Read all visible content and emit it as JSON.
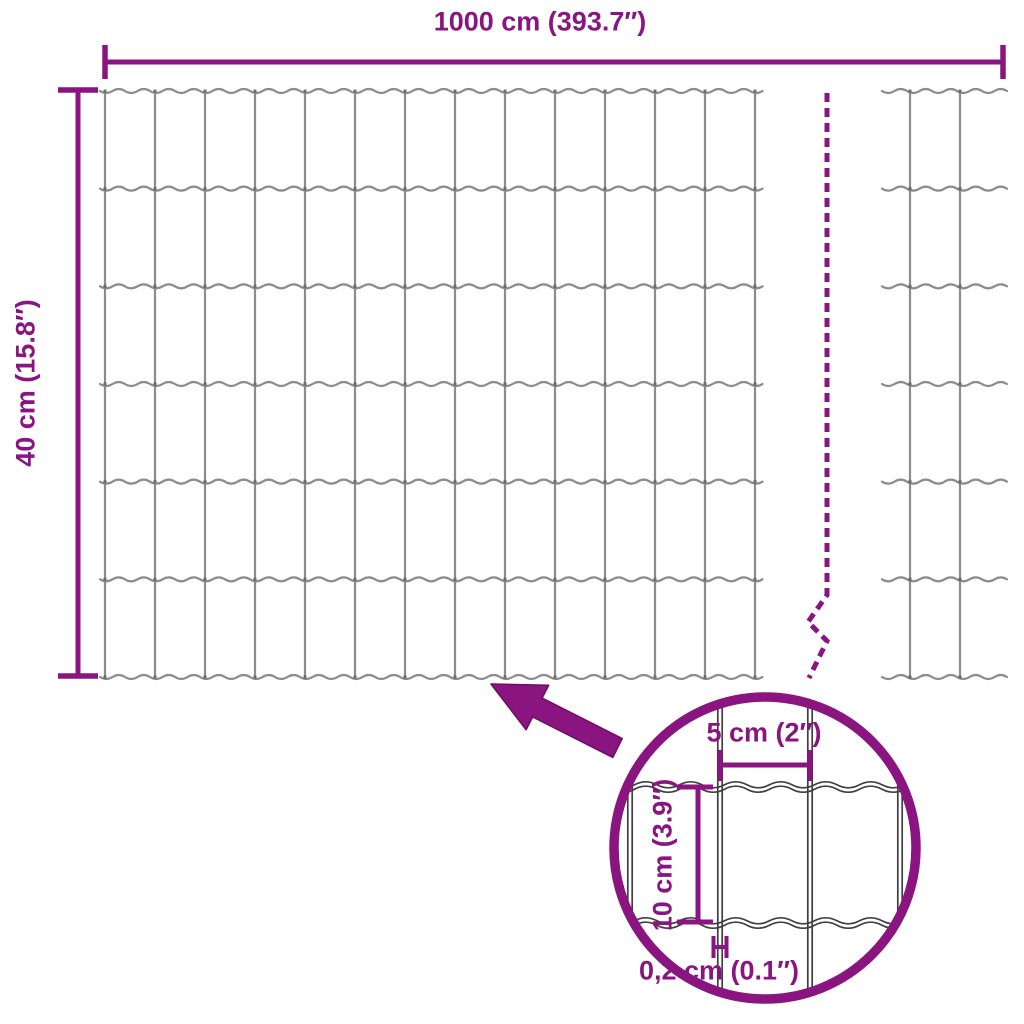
{
  "diagram": {
    "width_label": "1000 cm (393.7″)",
    "height_label": "40 cm (15.8″)",
    "detail": {
      "mesh_width_label": "5 cm (2″)",
      "mesh_height_label": "10 cm (3.9″)",
      "wire_thickness_label": "0,2 cm (0.1″)"
    }
  },
  "colors": {
    "accent": "#8a1480",
    "arrow_outline": "#6e0d63",
    "mesh": "#8c8c8c",
    "mesh_dark": "#3f3f3f",
    "background": "#ffffff"
  }
}
